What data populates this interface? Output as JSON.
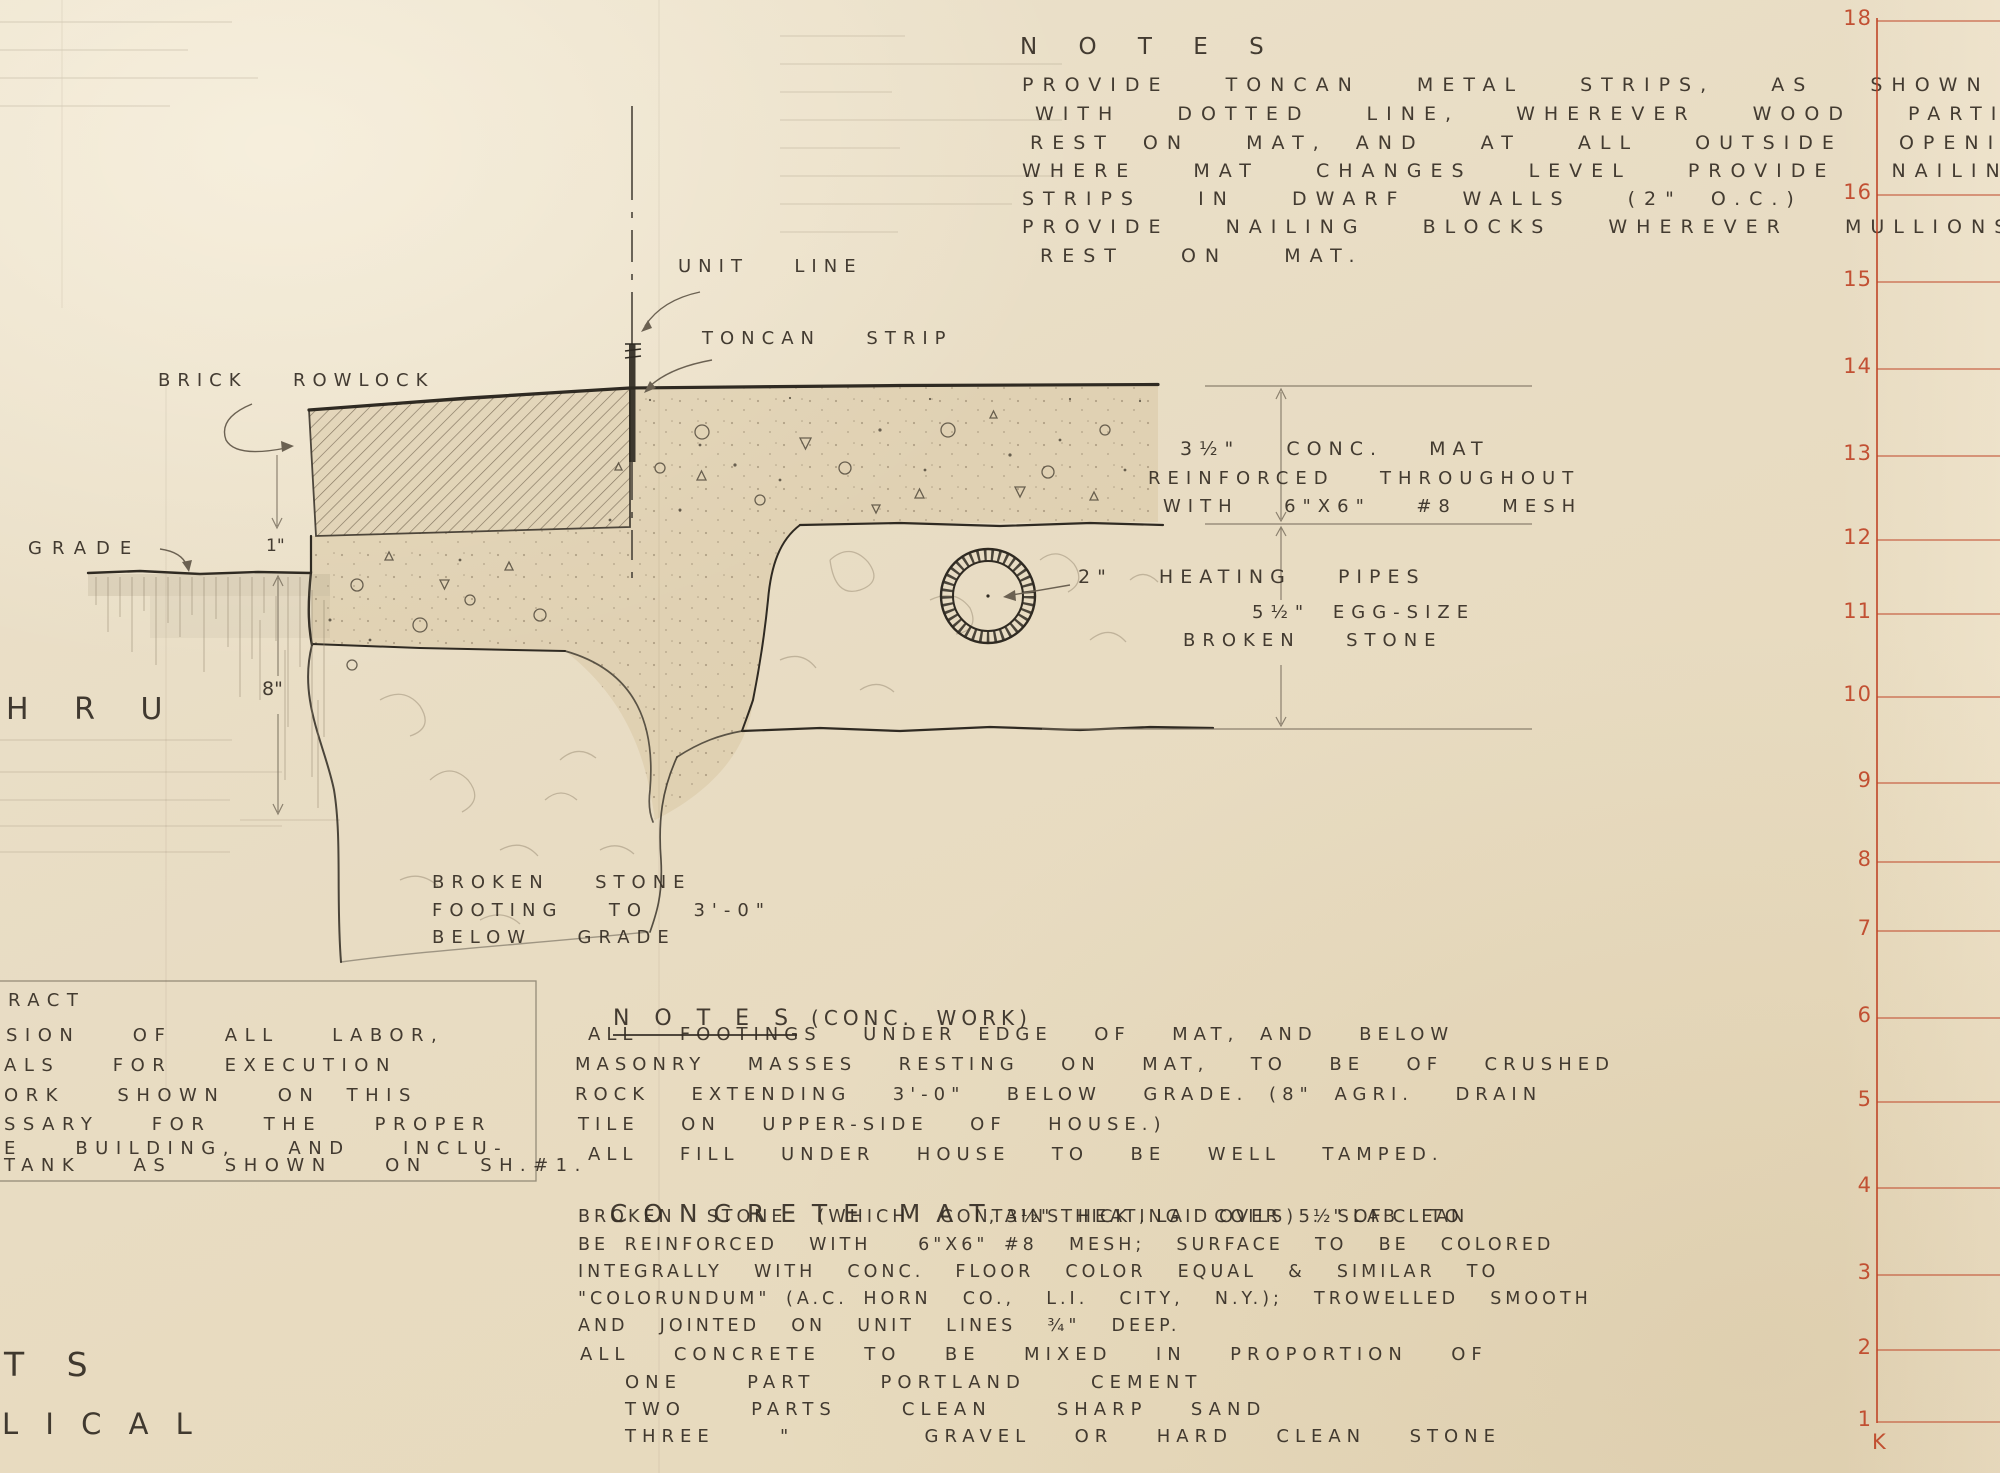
{
  "sheet_type": "architectural detail drawing",
  "colors": {
    "paper": "#e9ddc5",
    "ink": "#332d25",
    "pencil": "#8d8069",
    "ruler_red": "#bf4527",
    "concrete_tan": "#d7c6a2"
  },
  "notes_top": {
    "title": "N O T E S",
    "lines": [
      "PROVIDE  TONCAN  METAL  STRIPS,  AS  SHOWN",
      "WITH  DOTTED  LINE,  WHEREVER  WOOD  PARTITIONS",
      "REST ON  MAT, AND  AT  ALL  OUTSIDE  OPENINGS.",
      "WHERE  MAT  CHANGES  LEVEL  PROVIDE  NAILING",
      "STRIPS  IN  DWARF  WALLS  (2\" O.C.)",
      "PROVIDE  NAILING  BLOCKS  WHEREVER  MULLIONS",
      "REST  ON  MAT."
    ]
  },
  "drawing_labels": {
    "unit_line": "UNIT  LINE",
    "toncan_strip": "TONCAN  STRIP",
    "brick_rowlock": "BRICK  ROWLOCK",
    "grade": "GRADE",
    "dim_one_inch": "1\"",
    "dim_eight_inch": "8\"",
    "heating_pipes": "2\"  HEATING  PIPES",
    "mat_note_1": "3½\"  CONC.  MAT",
    "mat_note_2": "REINFORCED  THROUGHOUT",
    "mat_note_3": "WITH  6\"X6\"  #8  MESH",
    "stone_note_1": "5½\" EGG-SIZE",
    "stone_note_2": "BROKEN  STONE",
    "footing_note_1": "BROKEN  STONE",
    "footing_note_2": "FOOTING  TO  3'-0\"",
    "footing_note_3": "BELOW  GRADE"
  },
  "left_fragments": {
    "hru": "H R U",
    "ts": "T S",
    "lical": "L I C A L"
  },
  "left_block": {
    "lines": [
      "RACT",
      "SION  OF  ALL  LABOR,",
      "ALS  FOR  EXECUTION",
      "ORK  SHOWN  ON THIS",
      "SSARY  FOR  THE  PROPER",
      "E  BUILDING,  AND  INCLU-",
      "TANK  AS  SHOWN  ON  SH.#1."
    ]
  },
  "notes_conc": {
    "title": "N O T E S",
    "title_suffix": "(CONC.  WORK)",
    "lines": [
      "ALL  FOOTINGS  UNDER EDGE  OF  MAT, AND  BELOW",
      "MASONRY  MASSES  RESTING  ON  MAT,  TO  BE  OF  CRUSHED",
      "ROCK  EXTENDING  3'-0\"  BELOW  GRADE. (8\" AGRI.  DRAIN",
      "TILE  ON  UPPER-SIDE  OF  HOUSE.)",
      "ALL  FILL  UNDER  HOUSE  TO  BE  WELL  TAMPED."
    ]
  },
  "concrete_mat": {
    "heading": "C O N C R E T E   M A T",
    "heading_rest": ", 3½\" THICK , LAID OVER  5½\" OF CLEAN",
    "lines": [
      "BROKEN  STONE  (WHICH  CONTAINS HEATING  COILS) . SLAB  TO",
      "BE REINFORCED  WITH   6\"X6\" #8  MESH;  SURFACE  TO  BE  COLORED",
      "INTEGRALLY  WITH  CONC.  FLOOR  COLOR  EQUAL  &  SIMILAR  TO",
      "\"COLORUNDUM\" (A.C. HORN  CO.,  L.I.  CITY,  N.Y.);  TROWELLED  SMOOTH",
      "AND  JOINTED  ON  UNIT  LINES  ¾\"  DEEP."
    ]
  },
  "mix_proportions": {
    "lines": [
      "ALL  CONCRETE  TO  BE  MIXED  IN  PROPORTION  OF",
      "ONE   PART   PORTLAND   CEMENT",
      "TWO   PARTS   CLEAN   SHARP  SAND",
      "THREE   \"      GRAVEL  OR  HARD  CLEAN  STONE"
    ]
  },
  "ruler": {
    "marks": [
      "18",
      "16",
      "15",
      "14",
      "13",
      "12",
      "11",
      "10",
      "9",
      "8",
      "7",
      "6",
      "5",
      "4",
      "3",
      "2",
      "1"
    ],
    "corner_letter": "K",
    "color": "#bf4527"
  }
}
